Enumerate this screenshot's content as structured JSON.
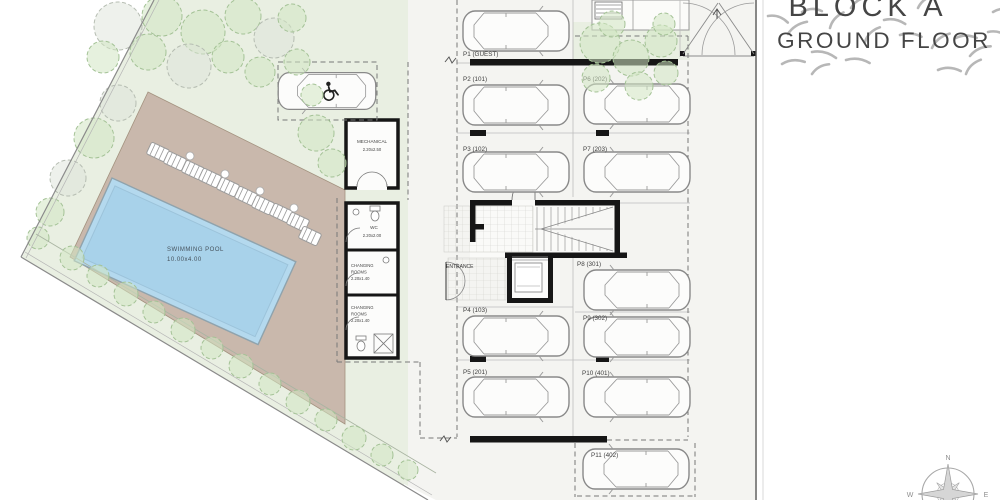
{
  "title": {
    "block": "BLOCK A",
    "floor": "GROUND FLOOR"
  },
  "compass": {
    "north": "N",
    "west": "W",
    "east": "E"
  },
  "site": {
    "pool": {
      "name": "SWIMMING POOL",
      "dimensions": "10.00x4.00"
    },
    "mechanical": {
      "name": "MECHANICAL",
      "dimensions": "2.20x2.50"
    },
    "wc": {
      "name": "WC",
      "dimensions": "2.20x2.00"
    },
    "changing_room_1": {
      "line1": "CHANGING",
      "line2": "ROOMS",
      "dimensions": "2.20x1.40"
    },
    "changing_room_2": {
      "line1": "CHANGING",
      "line2": "ROOMS",
      "dimensions": "2.20x1.40"
    },
    "entrance": "ENTRANCE"
  },
  "parking": {
    "stalls": [
      {
        "id": "P1",
        "label": "P1 (GUEST)"
      },
      {
        "id": "P2",
        "label": "P2 (101)"
      },
      {
        "id": "P3",
        "label": "P3 (102)"
      },
      {
        "id": "P4",
        "label": "P4 (103)"
      },
      {
        "id": "P5",
        "label": "P5 (201)"
      },
      {
        "id": "P6",
        "label": "P6 (202)"
      },
      {
        "id": "P7",
        "label": "P7 (203)"
      },
      {
        "id": "P8",
        "label": "P8 (301)"
      },
      {
        "id": "P9",
        "label": "P9 (302)"
      },
      {
        "id": "P10",
        "label": "P10 (401)"
      },
      {
        "id": "P11",
        "label": "P11 (402)"
      }
    ]
  },
  "colors": {
    "lawn": "#e9efe2",
    "deck": "#c9b8ac",
    "pool_water": "#b4d9ee",
    "parking_floor": "#f4f4f1",
    "wall": "#161616"
  }
}
